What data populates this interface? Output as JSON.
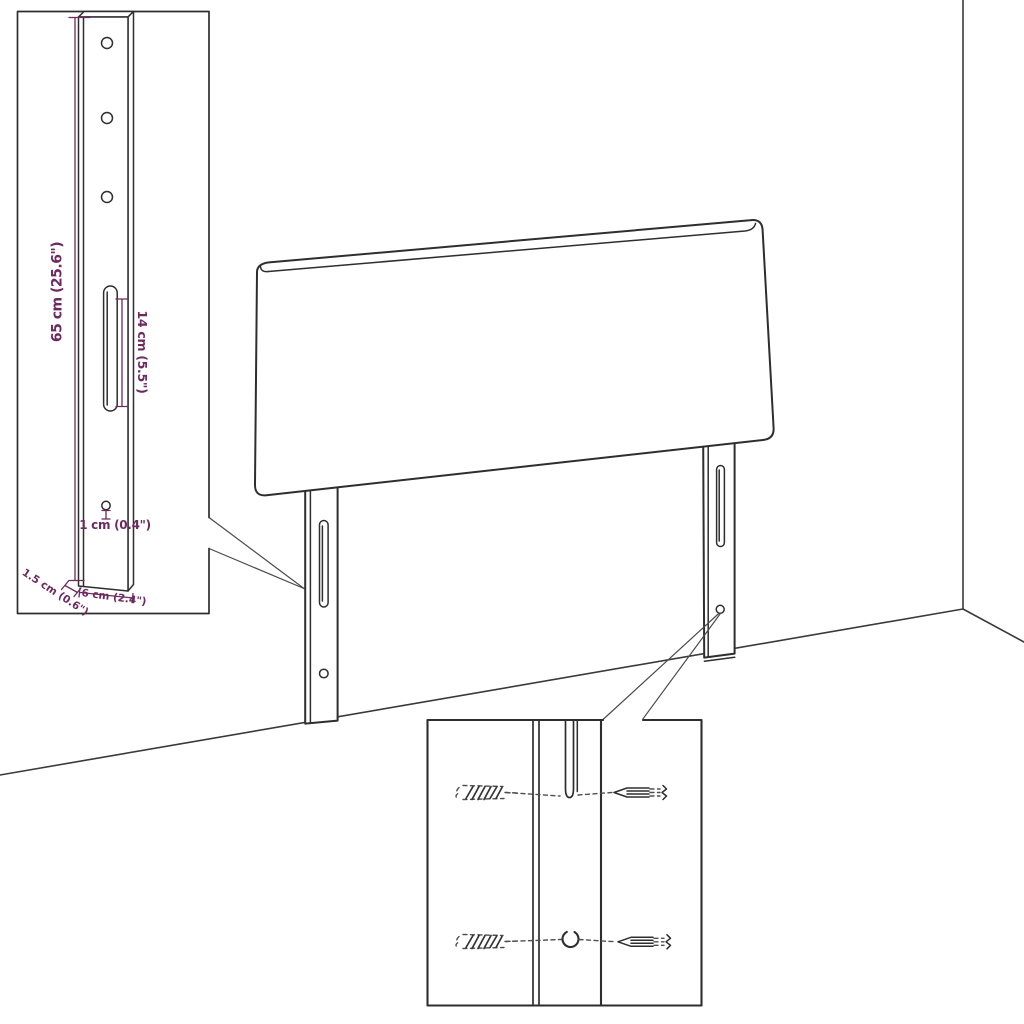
{
  "diagram": {
    "bracket_detail": {
      "height_label": "65 cm (25.6\")",
      "slot_length_label": "14 cm (5.5\")",
      "hole_diameter_label": "1 cm (0.4\")",
      "depth_label": "1.5 cm (0.6\")",
      "width_label": "6 cm (2.4\")"
    },
    "colors": {
      "dimension_color": "#6d2a60",
      "outline_color": "#2e2e2e",
      "background_color": "#ffffff"
    }
  }
}
